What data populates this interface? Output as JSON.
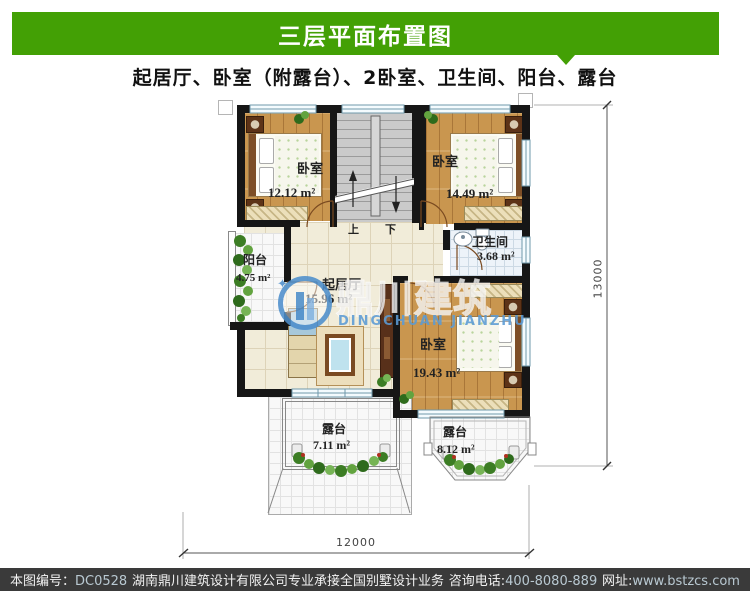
{
  "header": {
    "title": "三层平面布置图",
    "subtitle": "起居厅、卧室（附露台）、2卧室、卫生间、阳台、露台",
    "accent_color": "#43a005"
  },
  "plan": {
    "rooms": {
      "bedroom_tl": {
        "name": "卧室",
        "area": "12.12 m²"
      },
      "bedroom_tr": {
        "name": "卧室",
        "area": "14.49 m²"
      },
      "bathroom": {
        "name": "卫生间",
        "area": "3.68 m²"
      },
      "balcony": {
        "name": "阳台",
        "area": "4.75 m²"
      },
      "living": {
        "name": "起居厅",
        "area": "15.96 m²"
      },
      "bedroom_br": {
        "name": "卧室",
        "area": "19.43 m²"
      },
      "terrace_left": {
        "name": "露台",
        "area": "7.11 m²"
      },
      "terrace_right": {
        "name": "露台",
        "area": "8.12 m²"
      }
    },
    "stairs": {
      "up_label": "上",
      "down_label": "下"
    },
    "dimensions": {
      "bottom": "12000",
      "right": "13000"
    }
  },
  "watermark": {
    "brand_cn": "鼎川建筑",
    "brand_en": "DINGCHUAN JIANZHU",
    "blue": "#5b9bd5"
  },
  "footer": {
    "doc_no_label": "本图编号：",
    "doc_no": "DC0528",
    "company": "湖南鼎川建筑设计有限公司专业承接全国别墅设计业务",
    "phone_label": "咨询电话:",
    "phone": "400-8080-889",
    "website_label": "网址:",
    "website": "www.bstzcs.com"
  },
  "colors": {
    "wall": "#161616",
    "footer_bg": "#3a3a3a"
  }
}
